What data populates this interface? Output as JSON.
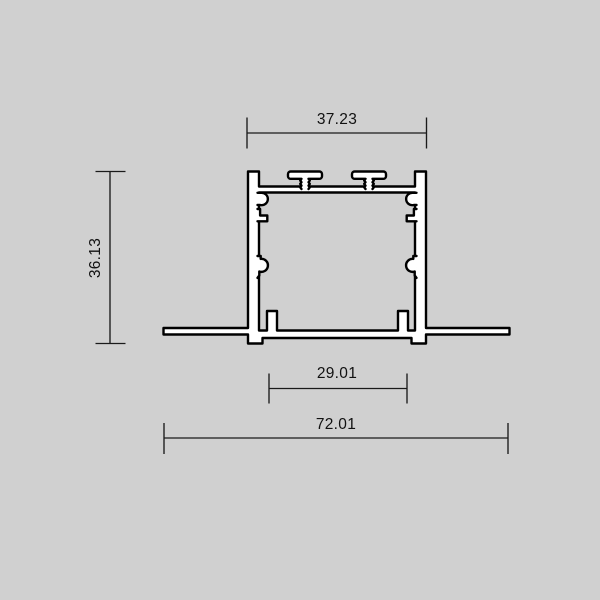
{
  "colors": {
    "background": "#d0d0d0",
    "outline": "#000000",
    "material_fill": "#ffffff",
    "dimension_lines": "#1a1a1a",
    "text": "#111111"
  },
  "dimensions": {
    "top_width": "37.23",
    "overall_height": "36.13",
    "inner_bottom_width": "29.01",
    "overall_width": "72.01"
  }
}
